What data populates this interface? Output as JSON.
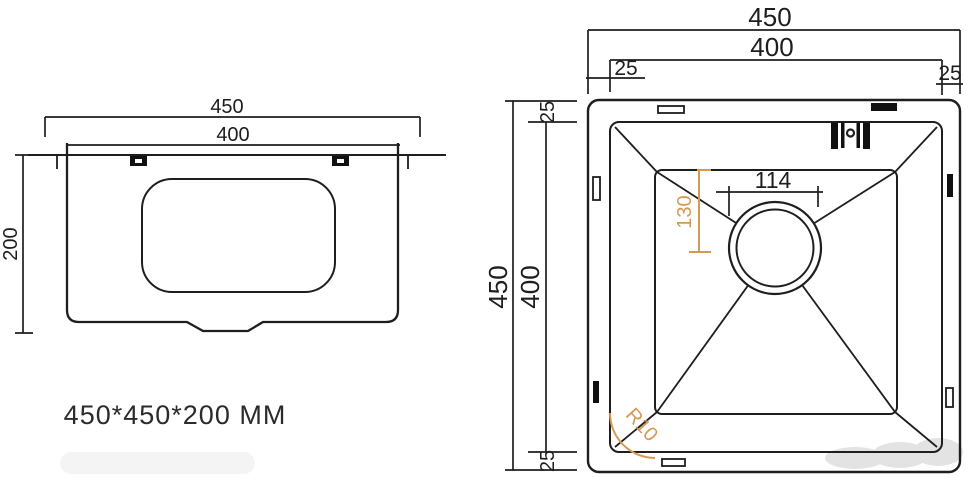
{
  "drawing": {
    "size_label": "450*450*200 MM",
    "line_color": "#1e1e1e",
    "accent_color": "#d49a54",
    "side_view": {
      "width_overall": "450",
      "width_bowl": "400",
      "height": "200"
    },
    "top_view": {
      "width_overall": "450",
      "width_inner": "400",
      "offset_left": "25",
      "offset_right": "25",
      "depth_overall": "450",
      "depth_inner": "400",
      "offset_top": "25",
      "offset_bottom": "25",
      "drain_width": "114",
      "drain_offset": "130",
      "corner_radius": "R10"
    }
  }
}
